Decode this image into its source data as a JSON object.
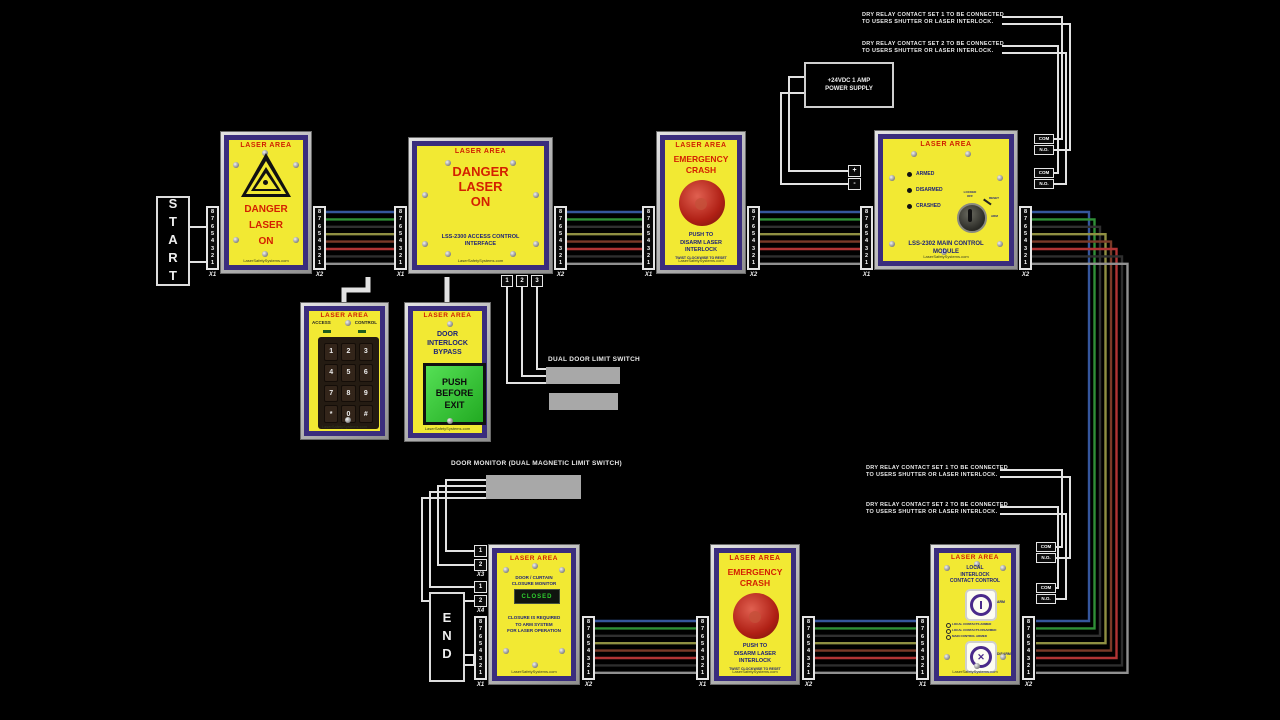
{
  "colors": {
    "background": "#000000",
    "panel_face": "#f2e933",
    "panel_border": "#3a2d7d",
    "frame_silver": "#c9c9c9",
    "danger_red": "#d42000",
    "navy_text": "#1a1f7a",
    "white_wire": "#e2e2e2",
    "gray_box": "#a8a8a8",
    "display_green": "#2fd12f",
    "button_green": "#35cc35",
    "crash_red": "#b02015"
  },
  "terminal_numbers": [
    "8",
    "7",
    "6",
    "5",
    "4",
    "3",
    "2",
    "1"
  ],
  "labels": {
    "x1": "X1",
    "x2": "X2",
    "x3": "X3",
    "x4": "X4",
    "com": "COM",
    "no": "N.O.",
    "plus": "+",
    "minus": "-"
  },
  "annotations": {
    "start": "START",
    "end": "END",
    "power_supply": [
      "+24VDC 1 AMP",
      "POWER SUPPLY"
    ],
    "dry_relay_set1": [
      "DRY RELAY CONTACT SET 1 TO BE CONNECTED",
      "TO USERS SHUTTER OR LASER INTERLOCK."
    ],
    "dry_relay_set2": [
      "DRY RELAY CONTACT SET 2 TO BE CONNECTED",
      "TO USERS SHUTTER OR LASER INTERLOCK."
    ],
    "dual_door": "DUAL DOOR LIMIT SWITCH",
    "door_monitor": "DOOR MONITOR (DUAL MAGNETIC LIMIT SWITCH)",
    "b_terms": [
      "1",
      "2",
      "3"
    ],
    "pair12": [
      "1",
      "2"
    ]
  },
  "panels": {
    "laser_on_sign": {
      "title": "LASER AREA",
      "danger": [
        "DANGER",
        "LASER",
        "ON"
      ],
      "site": "LaserSafetySystems.com"
    },
    "access_interface": {
      "title": "LASER AREA",
      "danger": [
        "DANGER",
        "LASER",
        "ON"
      ],
      "model": [
        "LSS-2300 ACCESS CONTROL",
        "INTERFACE"
      ],
      "site": "LaserSafetySystems.com"
    },
    "crash": {
      "title": "LASER AREA",
      "head": [
        "EMERGENCY",
        "CRASH"
      ],
      "push": [
        "PUSH TO",
        "DISARM LASER",
        "INTERLOCK"
      ],
      "reset_note": "TWIST CLOCKWISE TO RESET",
      "site": "LaserSafetySystems.com"
    },
    "main_module": {
      "title": "LASER AREA",
      "leds": [
        "ARMED",
        "DISARMED",
        "CRASHED"
      ],
      "key": {
        "locked": "LOCKED",
        "off": "OFF",
        "reset": "RESET",
        "arm": "ARM"
      },
      "model": [
        "LSS-2302 MAIN CONTROL",
        "MODULE"
      ],
      "site": "LaserSafetySystems.com"
    },
    "keypad": {
      "title": "LASER AREA",
      "access": "ACCESS",
      "control": "CONTROL",
      "keys": [
        "1",
        "2",
        "3",
        "4",
        "5",
        "6",
        "7",
        "8",
        "9",
        "*",
        "0",
        "#"
      ],
      "site": "LaserSafetySystems.com"
    },
    "bypass": {
      "title": "LASER AREA",
      "head": [
        "DOOR",
        "INTERLOCK",
        "BYPASS"
      ],
      "button": [
        "PUSH",
        "BEFORE",
        "EXIT"
      ],
      "site": "LaserSafetySystems.com"
    },
    "closure_monitor": {
      "title": "LASER AREA",
      "sub": [
        "DOOR / CURTAIN",
        "CLOSURE MONITOR"
      ],
      "display": "CLOSED",
      "note": [
        "CLOSURE IS REQUIRED",
        "TO ARM SYSTEM",
        "FOR LASER OPERATION"
      ],
      "site": "LaserSafetySystems.com"
    },
    "local_interlock": {
      "title": "LASER AREA",
      "sub": [
        "LOCAL",
        "INTERLOCK",
        "CONTACT CONTROL"
      ],
      "arm": "ARM",
      "disarm": "DISARM",
      "status": [
        "LOCAL CONTACTS ARMED",
        "LOCAL CONTACTS DISARMED",
        "MAIN CONTROL ARMED"
      ],
      "site": "LaserSafetySystems.com"
    }
  },
  "wiring": {
    "bus_colors": [
      "#35569c",
      "#2f8f37",
      "#303030",
      "#8f8f42",
      "#7a3a28",
      "#b03434",
      "#2e2e2e",
      "#909090"
    ],
    "buses": [
      {
        "x1": 326,
        "x2": 394,
        "y0": 212,
        "dy": 7.4
      },
      {
        "x1": 567,
        "x2": 642,
        "y0": 212,
        "dy": 7.4
      },
      {
        "x1": 760,
        "x2": 860,
        "y0": 212,
        "dy": 7.4
      },
      {
        "x1": 595,
        "x2": 696,
        "y0": 621,
        "dy": 7.4
      },
      {
        "x1": 815,
        "x2": 916,
        "y0": 621,
        "dy": 7.4
      }
    ],
    "loop": {
      "x_from": 1032,
      "y_top": 212,
      "x_base": 1089,
      "x_step": 5.5,
      "y_bot": 621,
      "dy": 7.4,
      "x_to": 1036
    },
    "wires": [
      {
        "p": [
          [
            206,
            227
          ],
          [
            184,
            227
          ],
          [
            184,
            262
          ],
          [
            206,
            262
          ]
        ]
      },
      {
        "p": [
          [
            459,
            655
          ],
          [
            474,
            655
          ],
          [
            474,
            665
          ],
          [
            459,
            665
          ],
          [
            459,
            655
          ]
        ]
      },
      {
        "p": [
          [
            806,
            77
          ],
          [
            789,
            77
          ],
          [
            789,
            171
          ],
          [
            848,
            171
          ]
        ]
      },
      {
        "p": [
          [
            806,
            93
          ],
          [
            781,
            93
          ],
          [
            781,
            184
          ],
          [
            848,
            184
          ]
        ]
      },
      {
        "p": [
          [
            1054,
            139
          ],
          [
            1062,
            139
          ],
          [
            1062,
            17
          ],
          [
            1002,
            17
          ]
        ]
      },
      {
        "p": [
          [
            1054,
            150
          ],
          [
            1070,
            150
          ],
          [
            1070,
            24
          ],
          [
            1002,
            24
          ]
        ]
      },
      {
        "p": [
          [
            1054,
            173
          ],
          [
            1058,
            173
          ],
          [
            1058,
            46
          ],
          [
            1002,
            46
          ]
        ]
      },
      {
        "p": [
          [
            1054,
            184
          ],
          [
            1066,
            184
          ],
          [
            1066,
            53
          ],
          [
            1002,
            53
          ]
        ]
      },
      {
        "p": [
          [
            1056,
            547
          ],
          [
            1062,
            547
          ],
          [
            1062,
            470
          ],
          [
            1000,
            470
          ]
        ]
      },
      {
        "p": [
          [
            1056,
            558
          ],
          [
            1070,
            558
          ],
          [
            1070,
            477
          ],
          [
            1000,
            477
          ]
        ]
      },
      {
        "p": [
          [
            1056,
            588
          ],
          [
            1058,
            588
          ],
          [
            1058,
            507
          ],
          [
            1000,
            507
          ]
        ]
      },
      {
        "p": [
          [
            1056,
            599
          ],
          [
            1066,
            599
          ],
          [
            1066,
            514
          ],
          [
            1000,
            514
          ]
        ]
      },
      {
        "p": [
          [
            368,
            277
          ],
          [
            368,
            290
          ],
          [
            344,
            290
          ],
          [
            344,
            303
          ]
        ],
        "w": 5
      },
      {
        "p": [
          [
            447,
            277
          ],
          [
            447,
            303
          ]
        ],
        "w": 5
      },
      {
        "p": [
          [
            507,
            287
          ],
          [
            507,
            383
          ],
          [
            546,
            383
          ]
        ]
      },
      {
        "p": [
          [
            522,
            287
          ],
          [
            522,
            376
          ],
          [
            546,
            376
          ]
        ]
      },
      {
        "p": [
          [
            537,
            287
          ],
          [
            537,
            369
          ],
          [
            546,
            369
          ]
        ]
      },
      {
        "p": [
          [
            486,
            480
          ],
          [
            446,
            480
          ],
          [
            446,
            551
          ],
          [
            474,
            551
          ]
        ]
      },
      {
        "p": [
          [
            486,
            486
          ],
          [
            438,
            486
          ],
          [
            438,
            565
          ],
          [
            474,
            565
          ]
        ]
      },
      {
        "p": [
          [
            486,
            492
          ],
          [
            430,
            492
          ],
          [
            430,
            587
          ],
          [
            474,
            587
          ]
        ]
      },
      {
        "p": [
          [
            486,
            498
          ],
          [
            422,
            498
          ],
          [
            422,
            601
          ],
          [
            474,
            601
          ]
        ]
      }
    ]
  }
}
